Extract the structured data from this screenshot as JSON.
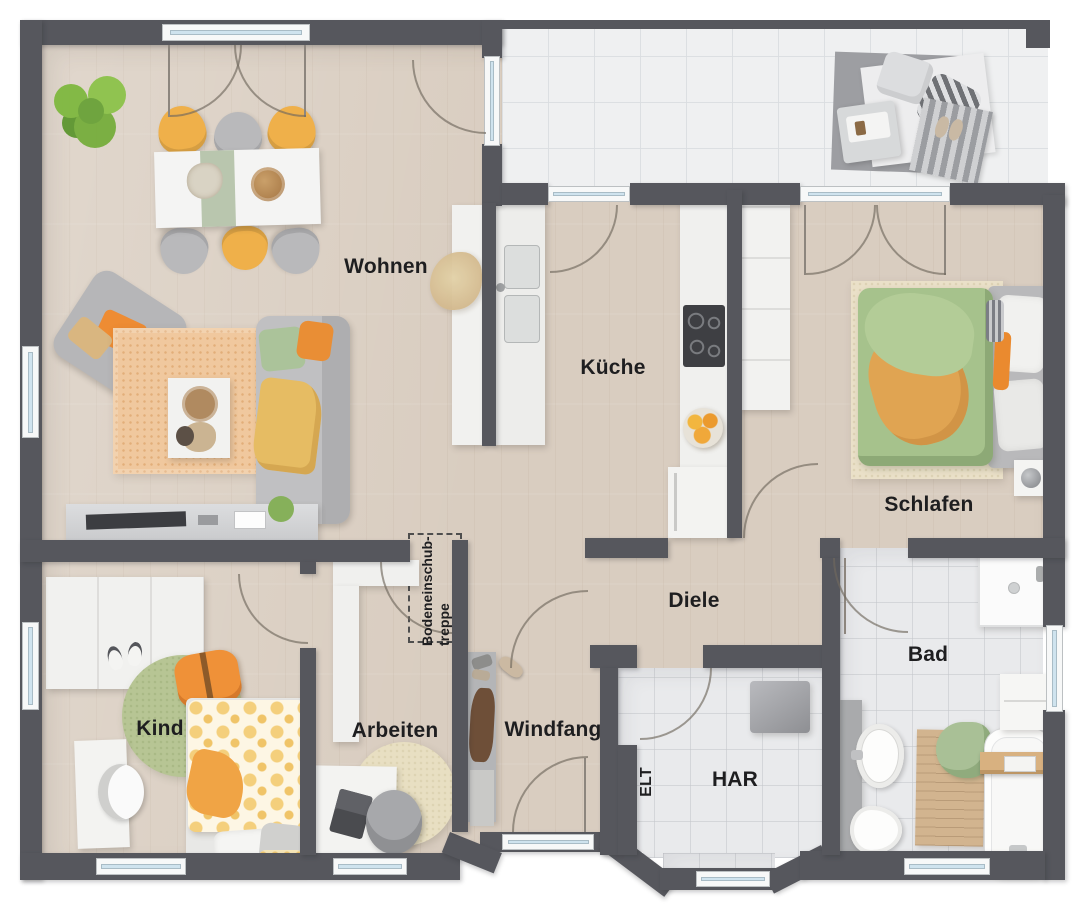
{
  "floorplan": {
    "rooms": [
      {
        "id": "wohnen",
        "label": "Wohnen"
      },
      {
        "id": "kueche",
        "label": "Küche"
      },
      {
        "id": "schlafen",
        "label": "Schlafen"
      },
      {
        "id": "diele",
        "label": "Diele"
      },
      {
        "id": "bad",
        "label": "Bad"
      },
      {
        "id": "kind",
        "label": "Kind"
      },
      {
        "id": "arbeiten",
        "label": "Arbeiten"
      },
      {
        "id": "windfang",
        "label": "Windfang"
      },
      {
        "id": "elt",
        "label": "ELT"
      },
      {
        "id": "har",
        "label": "HAR"
      }
    ],
    "annotations": {
      "attic_hatch": {
        "line1": "Bodeneinschub-",
        "line2": "treppe"
      }
    },
    "colors": {
      "wall": "#56575d",
      "wood_floor": "#d9cdc0",
      "tile_floor": "#e9eaec",
      "terrace_floor": "#eff0f1",
      "window_glass": "#cfe3ee",
      "accent_orange": "#ee8c33",
      "accent_green": "#a6c28c",
      "accent_yellow": "#eeb24c"
    }
  }
}
